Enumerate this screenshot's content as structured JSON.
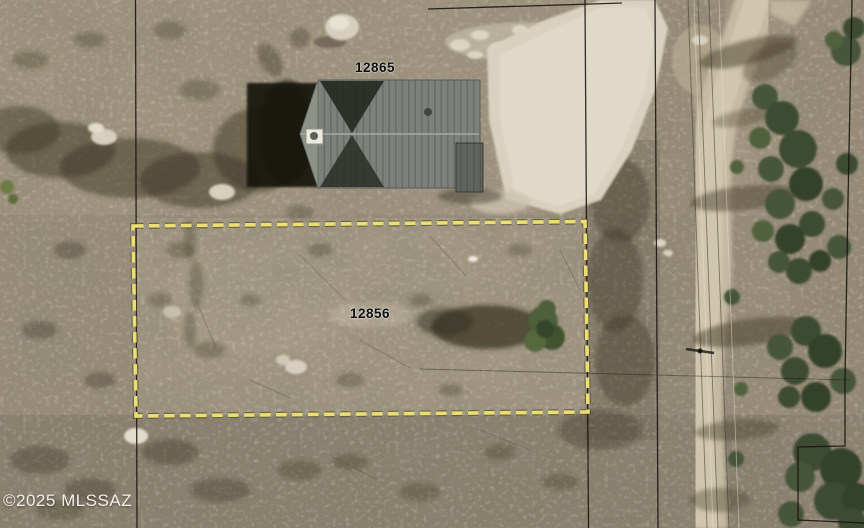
{
  "map": {
    "labels": {
      "house_parcel": "12865",
      "highlighted_parcel": "12856"
    },
    "watermark": "©2025 MLSSAZ",
    "highlight": {
      "style": "dashed-rectangle",
      "color": "#ecdf72",
      "outline_color": "#4a452c"
    }
  }
}
